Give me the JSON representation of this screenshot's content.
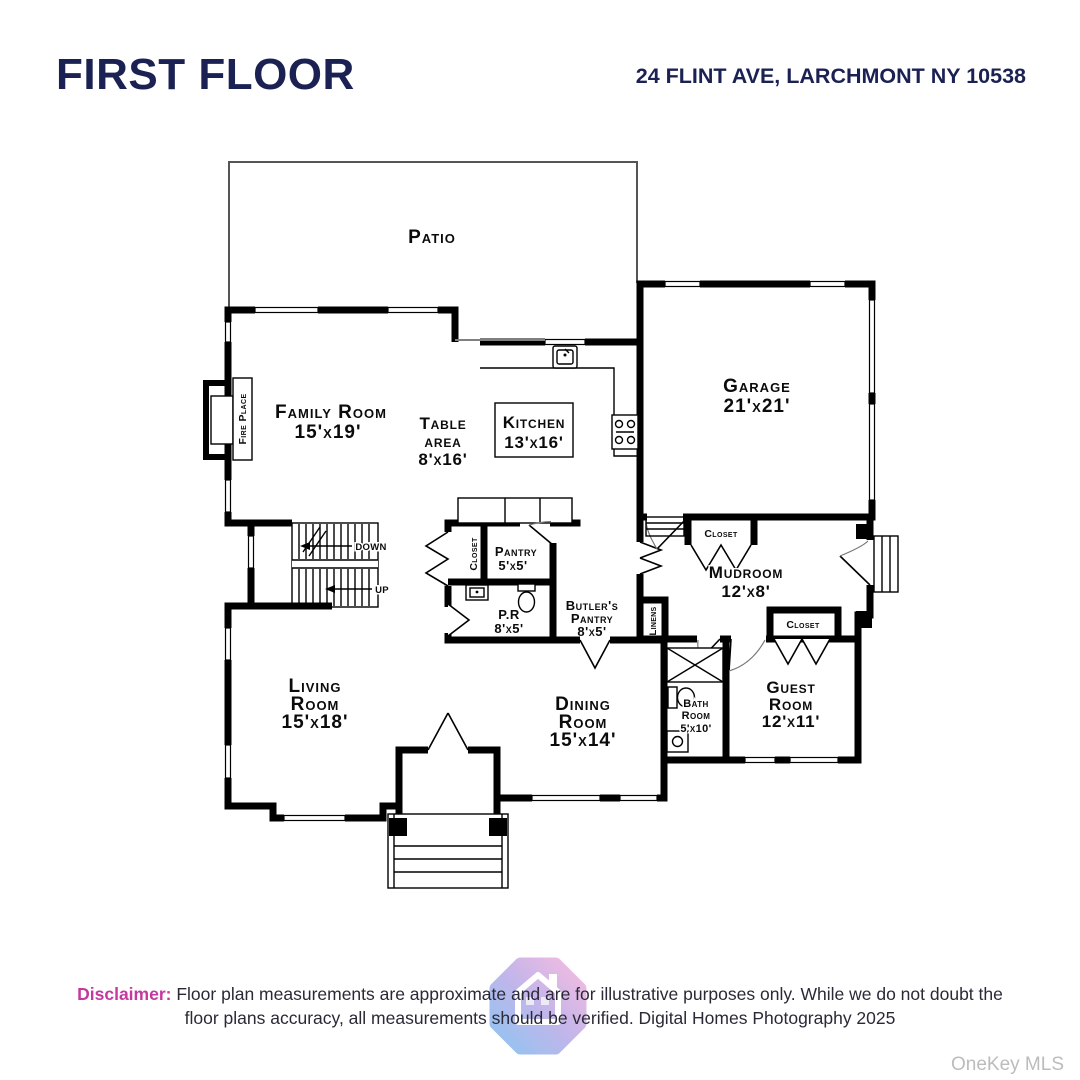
{
  "header": {
    "title": "FIRST FLOOR",
    "address": "24 FLINT AVE, LARCHMONT NY 10538"
  },
  "plan": {
    "patio": "Patio",
    "family": {
      "name": "Family Room",
      "dims": "15'x19'"
    },
    "table": {
      "l1": "Table",
      "l2": "area",
      "dims": "8'x16'"
    },
    "kitchen": {
      "name": "Kitchen",
      "dims": "13'x16'"
    },
    "garage": {
      "name": "Garage",
      "dims": "21'x21'"
    },
    "mudroom": {
      "name": "Mudroom",
      "dims": "12'x8'"
    },
    "pantry": {
      "name": "Pantry",
      "dims": "5'x5'"
    },
    "powder": {
      "name": "P.R",
      "dims": "8'x5'"
    },
    "butlers": {
      "l1": "Butler's",
      "l2": "Pantry",
      "dims": "8'x5'"
    },
    "living": {
      "l1": "Living",
      "l2": "Room",
      "dims": "15'x18'"
    },
    "dining": {
      "l1": "Dining",
      "l2": "Room",
      "dims": "15'x14'"
    },
    "bath": {
      "l1": "Bath",
      "l2": "Room",
      "dims": "5'x10'"
    },
    "guest": {
      "l1": "Guest",
      "l2": "Room",
      "dims": "12'x11'"
    },
    "closet": "Closet",
    "linens": "Linens",
    "fireplace": "Fire Place",
    "down": "DOWN",
    "up": "UP"
  },
  "footer": {
    "disclaimer_label": "Disclaimer:",
    "line1": "Floor plan measurements are approximate and are for illustrative purposes only. While we do not doubt the",
    "line2": "floor plans accuracy, all measurements should be verified. Digital Homes Photography 2025",
    "watermark": "OneKey MLS"
  },
  "colors": {
    "navy": "#1b2253",
    "pink": "#c4399f",
    "plan_line": "#000000",
    "watermark_gray": "#bcbcbc",
    "logo_pink": "#f2abd9",
    "logo_purple": "#b3a4e6",
    "logo_blue": "#74b6ee"
  }
}
